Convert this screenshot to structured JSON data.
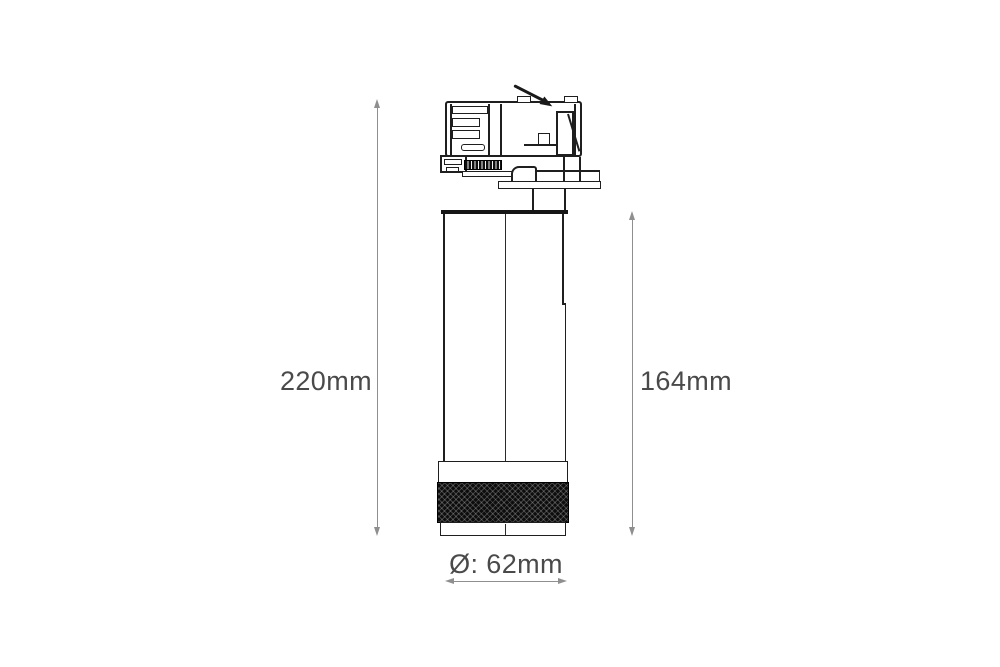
{
  "labels": {
    "overall_height": "220mm",
    "body_height": "164mm",
    "diameter": "Ø: 62mm"
  },
  "colors": {
    "background": "#ffffff",
    "outline": "#1f1f1f",
    "dimension_line": "#8f8f8f",
    "label_text": "#4a4a4a",
    "knurl": "#0d0d0d"
  }
}
